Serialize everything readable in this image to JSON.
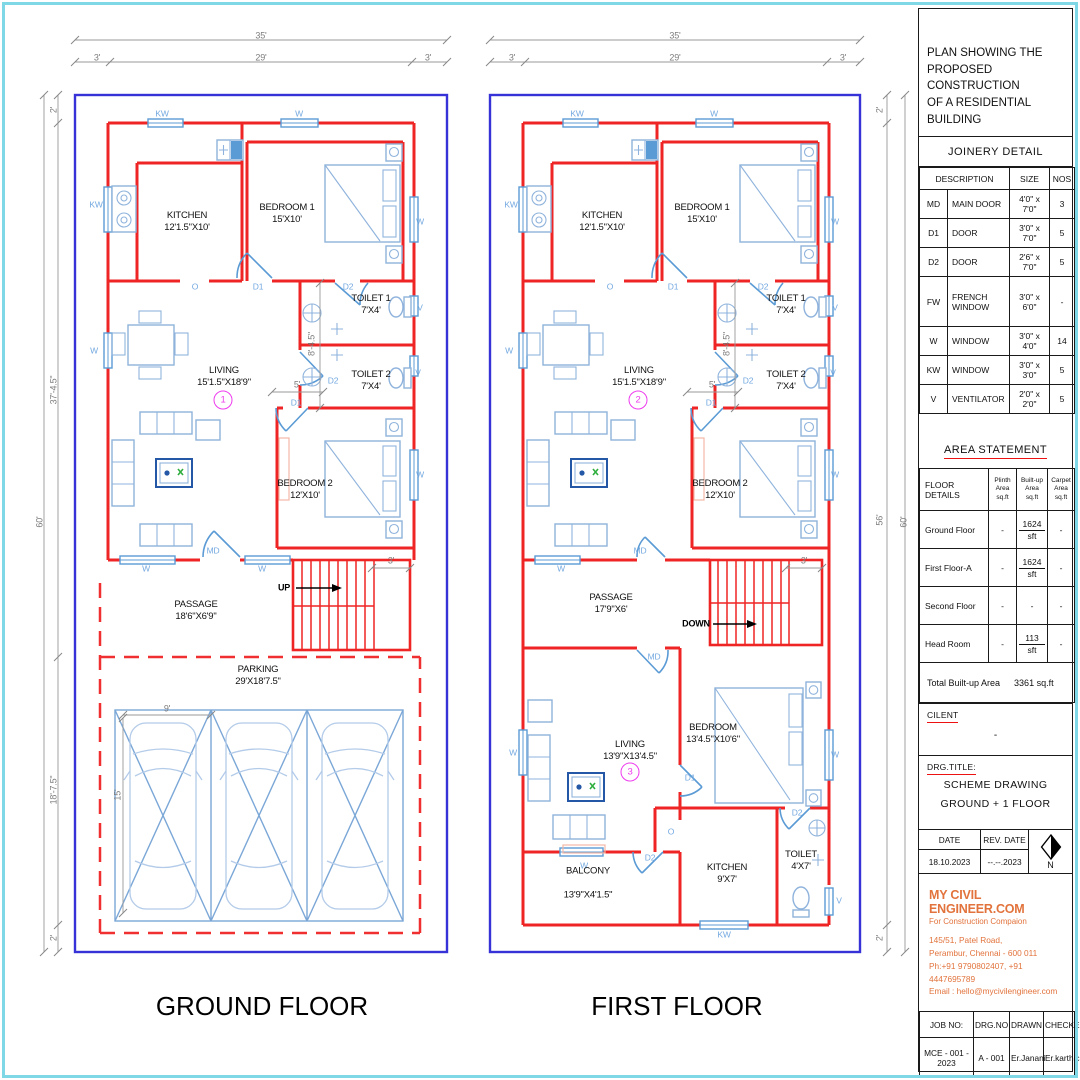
{
  "legend_note": "architectural plan sheet",
  "titleblock": {
    "heading": "PLAN SHOWING THE\nPROPOSED CONSTRUCTION\nOF A RESIDENTIAL BUILDING",
    "joinery": {
      "title": "JOINERY DETAIL",
      "headers": {
        "description": "DESCRIPTION",
        "size": "SIZE",
        "nos": "NOS"
      },
      "rows": [
        {
          "code": "MD",
          "desc": "MAIN DOOR",
          "size": "4'0\" x 7'0\"",
          "nos": "3"
        },
        {
          "code": "D1",
          "desc": "DOOR",
          "size": "3'0\" x 7'0\"",
          "nos": "5"
        },
        {
          "code": "D2",
          "desc": "DOOR",
          "size": "2'6\" x 7'0\"",
          "nos": "5"
        },
        {
          "code": "FW",
          "desc": "FRENCH\nWINDOW",
          "size": "3'0\" x 6'0\"",
          "nos": "-"
        },
        {
          "code": "W",
          "desc": "WINDOW",
          "size": "3'0\" x 4'0\"",
          "nos": "14"
        },
        {
          "code": "KW",
          "desc": "WINDOW",
          "size": "3'0\" x 3'0\"",
          "nos": "5"
        },
        {
          "code": "V",
          "desc": "VENTILATOR",
          "size": "2'0\" x 2'0\"",
          "nos": "5"
        }
      ]
    },
    "area": {
      "title": "AREA STATEMENT",
      "headers": {
        "floor": "FLOOR DETAILS",
        "plinth": "Plinth\nArea\nsq.ft",
        "built": "Built-up\nArea\nsq.ft",
        "carpet": "Carpet\nArea\nsq.ft"
      },
      "rows": [
        {
          "floor": "Ground Floor",
          "plinth": "-",
          "built": "1624",
          "unit": "sft",
          "carpet": "-"
        },
        {
          "floor": "First Floor-A",
          "plinth": "-",
          "built": "1624",
          "unit": "sft",
          "carpet": "-"
        },
        {
          "floor": "Second Floor",
          "plinth": "-",
          "built": "-",
          "unit": "",
          "carpet": "-"
        },
        {
          "floor": "Head Room",
          "plinth": "-",
          "built": "113",
          "unit": "sft",
          "carpet": "-"
        }
      ],
      "total_label": "Total Built-up Area",
      "total_value": "3361 sq.ft"
    },
    "client": {
      "label": "CILENT",
      "value": "-"
    },
    "drg": {
      "label": "DRG.TITLE:",
      "line1": "SCHEME DRAWING",
      "line2": "GROUND + 1 FLOOR"
    },
    "dates": {
      "date_label": "DATE",
      "rev_label": "REV. DATE",
      "date": "18.10.2023",
      "rev": "--.--.2023",
      "north": "N"
    },
    "company": {
      "name": "MY CIVIL ENGINEER.COM",
      "tagline": "For Construction Compaion",
      "addr1": "145/51, Patel Road,",
      "addr2": "Perambur, Chennai - 600 011",
      "addr3": "Ph:+91 9790802407, +91 4447695789",
      "addr4": "Email : hello@mycivilengineer.com"
    },
    "footer": {
      "job_label": "JOB NO:",
      "drg_label": "DRG.NO",
      "drawn_label": "DRAWN",
      "checked_label": "CHECKED",
      "job": "MCE - 001 - 2023",
      "drg": "A - 001",
      "drawn": "Er.Janani",
      "checked": "Er.karthic"
    }
  },
  "gf": {
    "labels": [
      {
        "t": "35'",
        "x": 261,
        "y": 36,
        "c": "dim"
      },
      {
        "t": "3'",
        "x": 97,
        "y": 58,
        "c": "dim"
      },
      {
        "t": "29'",
        "x": 261,
        "y": 58,
        "c": "dim"
      },
      {
        "t": "3'",
        "x": 428,
        "y": 58,
        "c": "dim"
      },
      {
        "t": "60'",
        "x": 40,
        "y": 522,
        "c": "dim v"
      },
      {
        "t": "2'",
        "x": 54,
        "y": 110,
        "c": "dim v"
      },
      {
        "t": "37'-4.5\"",
        "x": 54,
        "y": 390,
        "c": "dim v"
      },
      {
        "t": "18'-7.5\"",
        "x": 54,
        "y": 790,
        "c": "dim v"
      },
      {
        "t": "2'",
        "x": 54,
        "y": 938,
        "c": "dim v"
      },
      {
        "t": "8'-4.5\"",
        "x": 312,
        "y": 344,
        "c": "dim v"
      },
      {
        "t": "5'",
        "x": 297,
        "y": 385,
        "c": "dim"
      },
      {
        "t": "3'",
        "x": 391,
        "y": 561,
        "c": "dim"
      },
      {
        "t": "9'",
        "x": 167,
        "y": 709,
        "c": "dim"
      },
      {
        "t": "15'",
        "x": 118,
        "y": 795,
        "c": "dim v"
      },
      {
        "t": "KW",
        "x": 162,
        "y": 114,
        "c": "op"
      },
      {
        "t": "W",
        "x": 299,
        "y": 114,
        "c": "op"
      },
      {
        "t": "KW",
        "x": 96,
        "y": 205,
        "c": "op"
      },
      {
        "t": "W",
        "x": 94,
        "y": 351,
        "c": "op"
      },
      {
        "t": "W",
        "x": 420,
        "y": 222,
        "c": "op"
      },
      {
        "t": "V",
        "x": 420,
        "y": 308,
        "c": "op"
      },
      {
        "t": "V",
        "x": 418,
        "y": 373,
        "c": "op"
      },
      {
        "t": "W",
        "x": 420,
        "y": 475,
        "c": "op"
      },
      {
        "t": "O",
        "x": 195,
        "y": 287,
        "c": "op"
      },
      {
        "t": "D1",
        "x": 258,
        "y": 287,
        "c": "op"
      },
      {
        "t": "D2",
        "x": 348,
        "y": 287,
        "c": "op"
      },
      {
        "t": "D2",
        "x": 333,
        "y": 381,
        "c": "op"
      },
      {
        "t": "D1",
        "x": 296,
        "y": 403,
        "c": "op"
      },
      {
        "t": "W",
        "x": 146,
        "y": 569,
        "c": "op"
      },
      {
        "t": "MD",
        "x": 213,
        "y": 551,
        "c": "op"
      },
      {
        "t": "W",
        "x": 262,
        "y": 569,
        "c": "op"
      },
      {
        "t": "UP",
        "x": 284,
        "y": 588,
        "c": "lbl"
      },
      {
        "t": "KITCHEN\n12'1.5\"X10'",
        "x": 187,
        "y": 222,
        "c": "room",
        "n": "room-label-kitchen"
      },
      {
        "t": "BEDROOM 1\n15'X10'",
        "x": 287,
        "y": 214,
        "c": "room",
        "n": "room-label-bedroom1"
      },
      {
        "t": "TOILET 1\n7'X4'",
        "x": 371,
        "y": 305,
        "c": "room",
        "n": "room-label-toilet1"
      },
      {
        "t": "LIVING\n15'1.5\"X18'9\"",
        "x": 224,
        "y": 377,
        "c": "room",
        "n": "room-label-living"
      },
      {
        "t": "TOILET 2\n7'X4'",
        "x": 371,
        "y": 381,
        "c": "room",
        "n": "room-label-toilet2"
      },
      {
        "t": "BEDROOM 2\n12'X10'",
        "x": 305,
        "y": 490,
        "c": "room",
        "n": "room-label-bedroom2"
      },
      {
        "t": "PASSAGE\n18'6\"X6'9\"",
        "x": 196,
        "y": 611,
        "c": "room",
        "n": "room-label-passage"
      },
      {
        "t": "PARKING\n29'X18'7.5\"",
        "x": 258,
        "y": 676,
        "c": "room",
        "n": "room-label-parking"
      },
      {
        "t": "1",
        "x": 223,
        "y": 400,
        "c": "circ",
        "n": "plan-number-badge"
      },
      {
        "t": "GROUND FLOOR",
        "x": 262,
        "y": 1006,
        "c": "ftitle",
        "n": "floor-title-ground"
      }
    ]
  },
  "ff": {
    "labels": [
      {
        "t": "35'",
        "x": 675,
        "y": 36,
        "c": "dim"
      },
      {
        "t": "3'",
        "x": 512,
        "y": 58,
        "c": "dim"
      },
      {
        "t": "29'",
        "x": 675,
        "y": 58,
        "c": "dim"
      },
      {
        "t": "3'",
        "x": 843,
        "y": 58,
        "c": "dim"
      },
      {
        "t": "60'",
        "x": 904,
        "y": 522,
        "c": "dim v"
      },
      {
        "t": "2'",
        "x": 880,
        "y": 110,
        "c": "dim v"
      },
      {
        "t": "56'",
        "x": 880,
        "y": 520,
        "c": "dim v"
      },
      {
        "t": "2'",
        "x": 880,
        "y": 938,
        "c": "dim v"
      },
      {
        "t": "8'-4.5\"",
        "x": 727,
        "y": 344,
        "c": "dim v"
      },
      {
        "t": "5'",
        "x": 712,
        "y": 385,
        "c": "dim"
      },
      {
        "t": "3'",
        "x": 804,
        "y": 561,
        "c": "dim"
      },
      {
        "t": "KW",
        "x": 577,
        "y": 114,
        "c": "op"
      },
      {
        "t": "W",
        "x": 714,
        "y": 114,
        "c": "op"
      },
      {
        "t": "KW",
        "x": 511,
        "y": 205,
        "c": "op"
      },
      {
        "t": "W",
        "x": 509,
        "y": 351,
        "c": "op"
      },
      {
        "t": "W",
        "x": 835,
        "y": 222,
        "c": "op"
      },
      {
        "t": "V",
        "x": 835,
        "y": 308,
        "c": "op"
      },
      {
        "t": "V",
        "x": 833,
        "y": 373,
        "c": "op"
      },
      {
        "t": "W",
        "x": 835,
        "y": 475,
        "c": "op"
      },
      {
        "t": "O",
        "x": 610,
        "y": 287,
        "c": "op"
      },
      {
        "t": "D1",
        "x": 673,
        "y": 287,
        "c": "op"
      },
      {
        "t": "D2",
        "x": 763,
        "y": 287,
        "c": "op"
      },
      {
        "t": "D2",
        "x": 748,
        "y": 381,
        "c": "op"
      },
      {
        "t": "D1",
        "x": 711,
        "y": 403,
        "c": "op"
      },
      {
        "t": "W",
        "x": 561,
        "y": 569,
        "c": "op"
      },
      {
        "t": "MD",
        "x": 640,
        "y": 551,
        "c": "op"
      },
      {
        "t": "MD",
        "x": 654,
        "y": 657,
        "c": "op"
      },
      {
        "t": "DOWN",
        "x": 696,
        "y": 624,
        "c": "lbl"
      },
      {
        "t": "W",
        "x": 513,
        "y": 753,
        "c": "op"
      },
      {
        "t": "D1",
        "x": 690,
        "y": 778,
        "c": "op"
      },
      {
        "t": "O",
        "x": 671,
        "y": 832,
        "c": "op"
      },
      {
        "t": "D2",
        "x": 650,
        "y": 858,
        "c": "op"
      },
      {
        "t": "D2",
        "x": 797,
        "y": 813,
        "c": "op"
      },
      {
        "t": "W",
        "x": 584,
        "y": 866,
        "c": "op"
      },
      {
        "t": "KW",
        "x": 724,
        "y": 935,
        "c": "op"
      },
      {
        "t": "V",
        "x": 839,
        "y": 901,
        "c": "op"
      },
      {
        "t": "W",
        "x": 835,
        "y": 755,
        "c": "op"
      },
      {
        "t": "KITCHEN\n12'1.5\"X10'",
        "x": 602,
        "y": 222,
        "c": "room",
        "n": "room-label-kitchen"
      },
      {
        "t": "BEDROOM 1\n15'X10'",
        "x": 702,
        "y": 214,
        "c": "room",
        "n": "room-label-bedroom1"
      },
      {
        "t": "TOILET 1\n7'X4'",
        "x": 786,
        "y": 305,
        "c": "room",
        "n": "room-label-toilet1"
      },
      {
        "t": "LIVING\n15'1.5\"X18'9\"",
        "x": 639,
        "y": 377,
        "c": "room",
        "n": "room-label-living"
      },
      {
        "t": "TOILET 2\n7'X4'",
        "x": 786,
        "y": 381,
        "c": "room",
        "n": "room-label-toilet2"
      },
      {
        "t": "BEDROOM 2\n12'X10'",
        "x": 720,
        "y": 490,
        "c": "room",
        "n": "room-label-bedroom2"
      },
      {
        "t": "PASSAGE\n17'9\"X6'",
        "x": 611,
        "y": 604,
        "c": "room",
        "n": "room-label-passage"
      },
      {
        "t": "BEDROOM\n13'4.5\"X10'6\"",
        "x": 713,
        "y": 734,
        "c": "room",
        "n": "room-label-bedroom"
      },
      {
        "t": "LIVING\n13'9\"X13'4.5\"",
        "x": 630,
        "y": 751,
        "c": "room",
        "n": "room-label-living-lower"
      },
      {
        "t": "BALCONY\n13'9\"X4'1.5\"",
        "x": 588,
        "y": 883,
        "c": "room gap2",
        "n": "room-label-balcony"
      },
      {
        "t": "KITCHEN\n9'X7'",
        "x": 727,
        "y": 874,
        "c": "room",
        "n": "room-label-kitchen-lower"
      },
      {
        "t": "TOILET\n4'X7'",
        "x": 801,
        "y": 861,
        "c": "room",
        "n": "room-label-toilet-lower"
      },
      {
        "t": "2",
        "x": 638,
        "y": 400,
        "c": "circ",
        "n": "plan-number-badge"
      },
      {
        "t": "3",
        "x": 630,
        "y": 772,
        "c": "circ",
        "n": "plan-number-badge"
      },
      {
        "t": "FIRST FLOOR",
        "x": 677,
        "y": 1006,
        "c": "ftitle",
        "n": "floor-title-first"
      }
    ]
  }
}
